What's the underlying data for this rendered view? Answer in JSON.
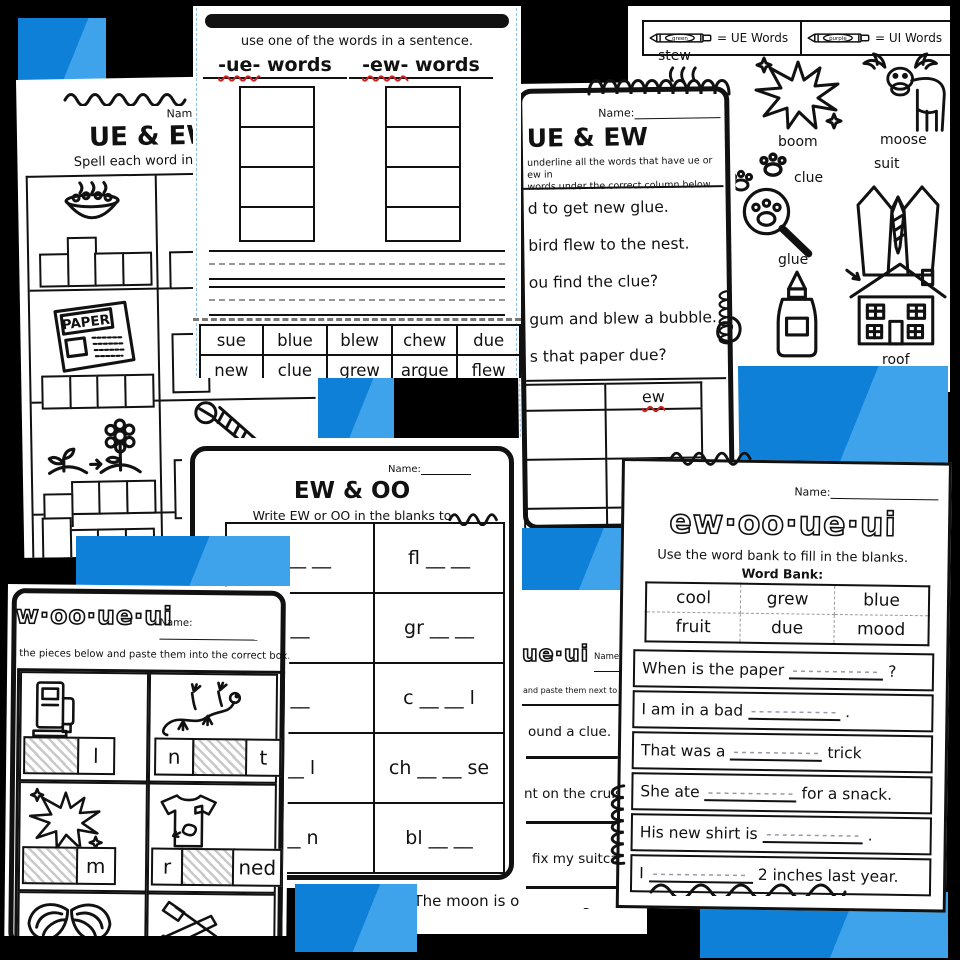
{
  "colors": {
    "background": "#000000",
    "accent_blue": "#0f80d8",
    "accent_blue_light": "#3ea3ea",
    "page_white": "#ffffff",
    "ink": "#111111",
    "squiggle_red": "#cc2222"
  },
  "page_spell": {
    "name_label": "Name:",
    "title": "UE & EW",
    "subtitle": "Spell each word in the b",
    "paper_word": "PAPER"
  },
  "page_sort": {
    "instruction": "use one of the words in a sentence.",
    "col_ue_prefix": "-ue-",
    "col_ue_suffix": " words",
    "col_ew_prefix": "-ew-",
    "col_ew_suffix": " words",
    "word_bank": [
      [
        "sue",
        "blue",
        "blew",
        "chew",
        "due"
      ],
      [
        "new",
        "clue",
        "grew",
        "argue",
        "flew"
      ]
    ]
  },
  "page_underline": {
    "name_label": "Name:",
    "title": "UE & EW",
    "instruction_line1": "underline all the words that have ue or ew in",
    "instruction_line2": "words under the correct column below.",
    "sentences": [
      "d to get new glue.",
      "bird flew to the nest.",
      "ou find the clue?",
      "gum and blew a bubble.",
      "s that paper due?"
    ],
    "column_header": "ew"
  },
  "page_colorcode": {
    "legend": [
      {
        "crayon_word": "green",
        "label": "= UE Words"
      },
      {
        "crayon_word": "purple",
        "label": "= UI Words"
      }
    ],
    "pictures": [
      {
        "label": "stew"
      },
      {
        "label": "boom"
      },
      {
        "label": "moose"
      },
      {
        "label": "clue"
      },
      {
        "label": "suit"
      },
      {
        "label": "glue"
      },
      {
        "label": "roof"
      }
    ]
  },
  "page_ew_oo": {
    "name_label": "Name:",
    "title": "EW & OO",
    "subtitle": "Write EW or OO in the blanks to",
    "rows": [
      {
        "left": "b __ __",
        "right": "fl __ __"
      },
      {
        "left": "__",
        "right": "gr __ __"
      },
      {
        "left": "__",
        "right": "c __ __ l"
      },
      {
        "left": "__ l",
        "right": "ch __ __ se"
      },
      {
        "left": "__ n",
        "right": "bl __ __"
      }
    ]
  },
  "page_cut_box": {
    "title": "w·oo·ue·ui",
    "name_label": "Name:",
    "instruction": "the pieces below and paste them into the correct box.",
    "items": [
      {
        "icon": "gas-pump",
        "tiles": [
          {
            "hatched": true,
            "letter": ""
          },
          {
            "hatched": false,
            "letter": "l"
          }
        ]
      },
      {
        "icon": "gecko",
        "tiles": [
          {
            "hatched": false,
            "letter": "n"
          },
          {
            "hatched": true,
            "letter": ""
          },
          {
            "hatched": false,
            "letter": "t"
          }
        ]
      },
      {
        "icon": "boom-burst",
        "tiles": [
          {
            "hatched": true,
            "letter": ""
          },
          {
            "hatched": false,
            "letter": "m"
          }
        ]
      },
      {
        "icon": "shirt-stain",
        "tiles": [
          {
            "hatched": false,
            "letter": "r"
          },
          {
            "hatched": true,
            "letter": ""
          },
          {
            "hatched": false,
            "letter": "ned"
          }
        ]
      },
      {
        "icon": "wings",
        "tiles": [
          {
            "hatched": false,
            "letter": "fl"
          },
          {
            "hatched": true,
            "letter": ""
          },
          {
            "hatched": false,
            "letter": ""
          }
        ]
      },
      {
        "icon": "saw-hammer",
        "tiles": [
          {
            "hatched": false,
            "letter": "t"
          },
          {
            "hatched": true,
            "letter": ""
          },
          {
            "hatched": false,
            "letter": "ls"
          }
        ]
      }
    ]
  },
  "page_cut_sentences": {
    "title": "ue·ui",
    "name_label": "Name",
    "instruction": "and paste them next to th",
    "sentences": [
      "ound a clue.",
      "nt on the cruise.",
      "fix my suitcase."
    ],
    "moon_sentence": "The moon is over the igloo."
  },
  "page_word_bank": {
    "name_label": "Name:",
    "title": "ew·oo·ue·ui",
    "subtitle": "Use the word bank to fill in the blanks.",
    "word_bank_label": "Word Bank:",
    "word_bank": [
      [
        "cool",
        "grew",
        "blue"
      ],
      [
        "fruit",
        "due",
        "mood"
      ]
    ],
    "sentences": [
      {
        "before": "When is the paper",
        "after": "?"
      },
      {
        "before": "I am in a bad",
        "after": "."
      },
      {
        "before": "That was a",
        "after": "trick"
      },
      {
        "before": "She ate",
        "after": "for a snack."
      },
      {
        "before": "His new shirt is",
        "after": "."
      },
      {
        "before": "I",
        "after": "2 inches last year."
      }
    ]
  }
}
